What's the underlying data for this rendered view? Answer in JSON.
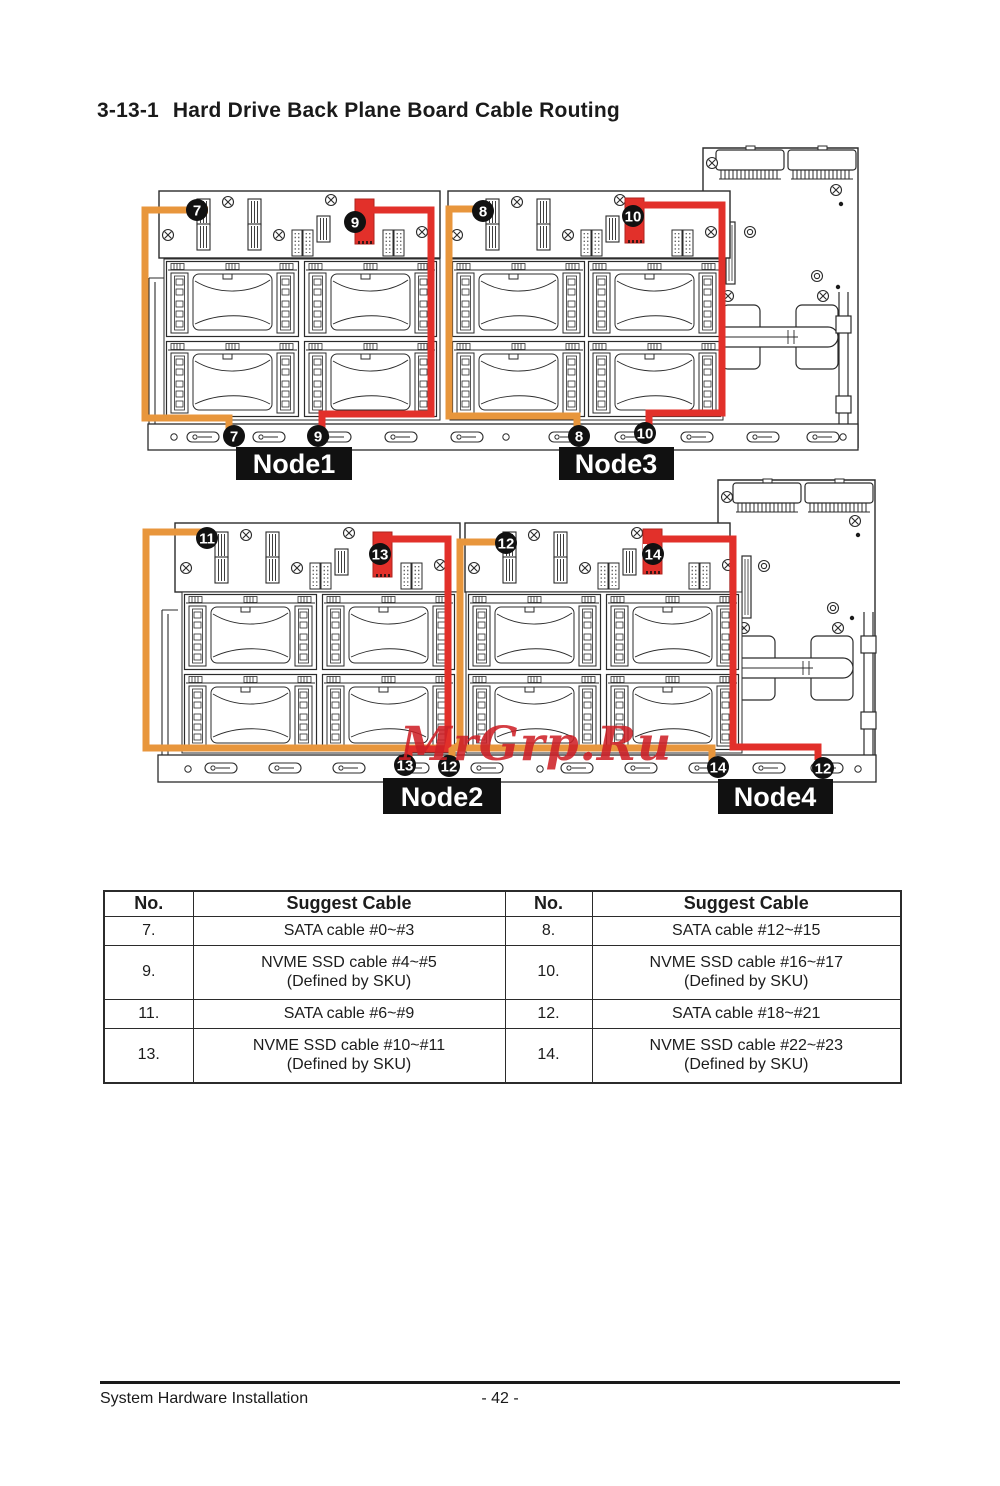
{
  "page": {
    "section": "3-13-1",
    "title": "Hard Drive Back Plane Board Cable Routing",
    "watermark": "MrGrp.Ru",
    "footer_left": "System Hardware Installation",
    "footer_page": "- 42 -"
  },
  "colors": {
    "sata_cable_orange": "#E8963C",
    "nvme_cable_red": "#E2302A",
    "callout_background": "#111111",
    "node_label_background": "#111111"
  },
  "diagrams": {
    "top": {
      "node_left": "Node1",
      "node_right": "Node3",
      "callouts": {
        "t1": "7",
        "t2": "9",
        "t3": "8",
        "t4": "10",
        "b1": "7",
        "b2": "9",
        "b3": "8",
        "b4": "10"
      }
    },
    "bottom": {
      "node_left": "Node2",
      "node_right": "Node4",
      "callouts": {
        "t1": "11",
        "t2": "13",
        "t3": "12",
        "t4": "14",
        "b1": "13",
        "b2": "12",
        "b3": "14",
        "b4": "12"
      }
    }
  },
  "table": {
    "headers": [
      "No.",
      "Suggest Cable",
      "No.",
      "Suggest Cable"
    ],
    "rows": [
      {
        "n1": "7.",
        "c1a": "SATA cable #0~#3",
        "n2": "8.",
        "c2a": "SATA cable #12~#15"
      },
      {
        "n1": "9.",
        "c1a": "NVME SSD cable #4~#5",
        "c1b": "(Defined by SKU)",
        "n2": "10.",
        "c2a": "NVME SSD cable #16~#17",
        "c2b": "(Defined by SKU)"
      },
      {
        "n1": "11.",
        "c1a": "SATA cable #6~#9",
        "n2": "12.",
        "c2a": "SATA cable #18~#21"
      },
      {
        "n1": "13.",
        "c1a": "NVME SSD cable #10~#11",
        "c1b": "(Defined by SKU)",
        "n2": "14.",
        "c2a": "NVME SSD cable #22~#23",
        "c2b": "(Defined by SKU)"
      }
    ]
  }
}
